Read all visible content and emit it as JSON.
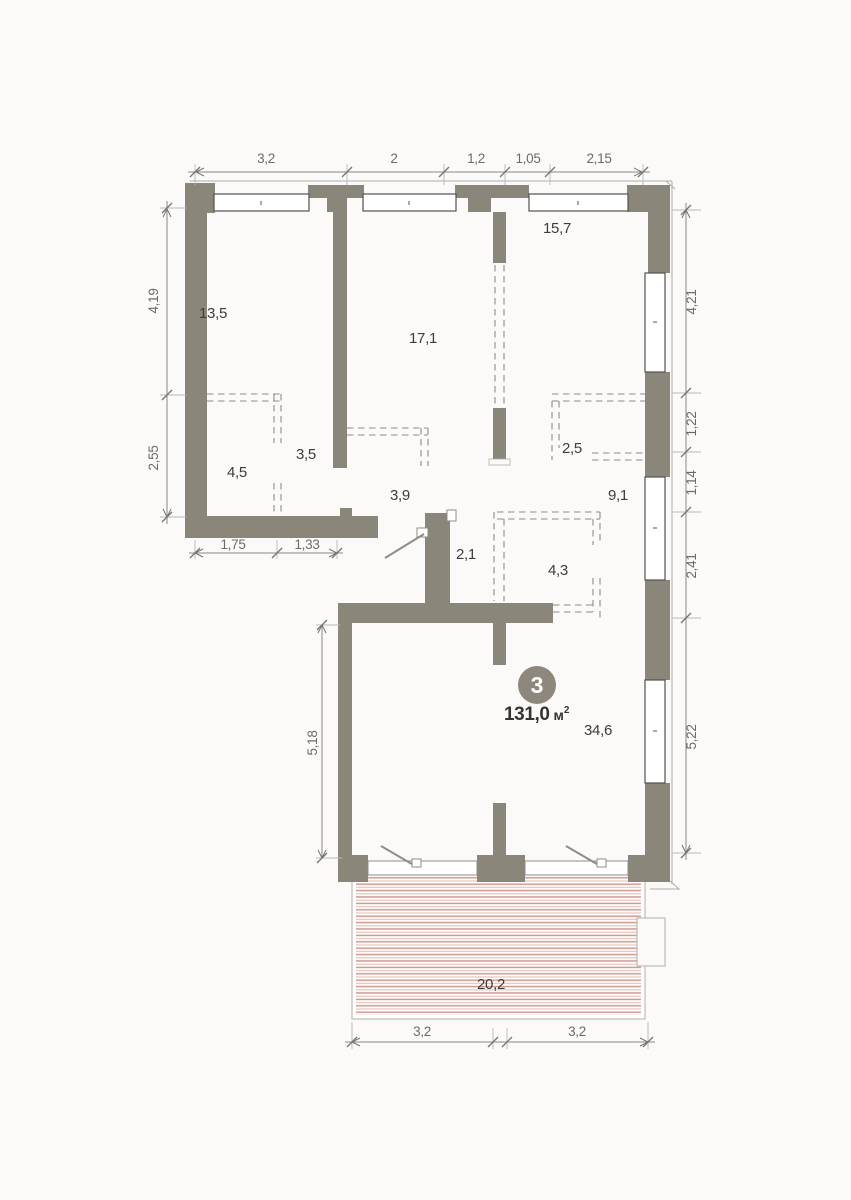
{
  "unit": {
    "number": "3",
    "area_value": "131,0",
    "area_unit_base": "м",
    "area_unit_exp": "2"
  },
  "areas": {
    "room_top_left": "13,5",
    "room_center": "17,1",
    "room_top_right": "15,7",
    "nook_left_a": "4,5",
    "nook_left_b": "3,5",
    "closet_right": "2,5",
    "hallway": "3,9",
    "corridor": "9,1",
    "small_room": "2,1",
    "wardrobe": "4,3",
    "living_room": "34,6",
    "terrace": "20,2"
  },
  "dims": {
    "top": [
      "3,2",
      "2",
      "1,2",
      "1,05",
      "2,15"
    ],
    "left": [
      "4,19",
      "2,55"
    ],
    "right": [
      "4,21",
      "1,22",
      "1,14",
      "2,41",
      "5,22"
    ],
    "inner": [
      "1,75",
      "1,33"
    ],
    "living_height": "5,18",
    "bottom": [
      "3,2",
      "3,2"
    ]
  },
  "colors": {
    "wall": "#8b867a",
    "badge": "#8d887b",
    "hatch_dark": "#cd9287",
    "hatch_light": "#ebc6bf",
    "dim_line": "#8a8882",
    "room_text": "#3d3c38"
  }
}
